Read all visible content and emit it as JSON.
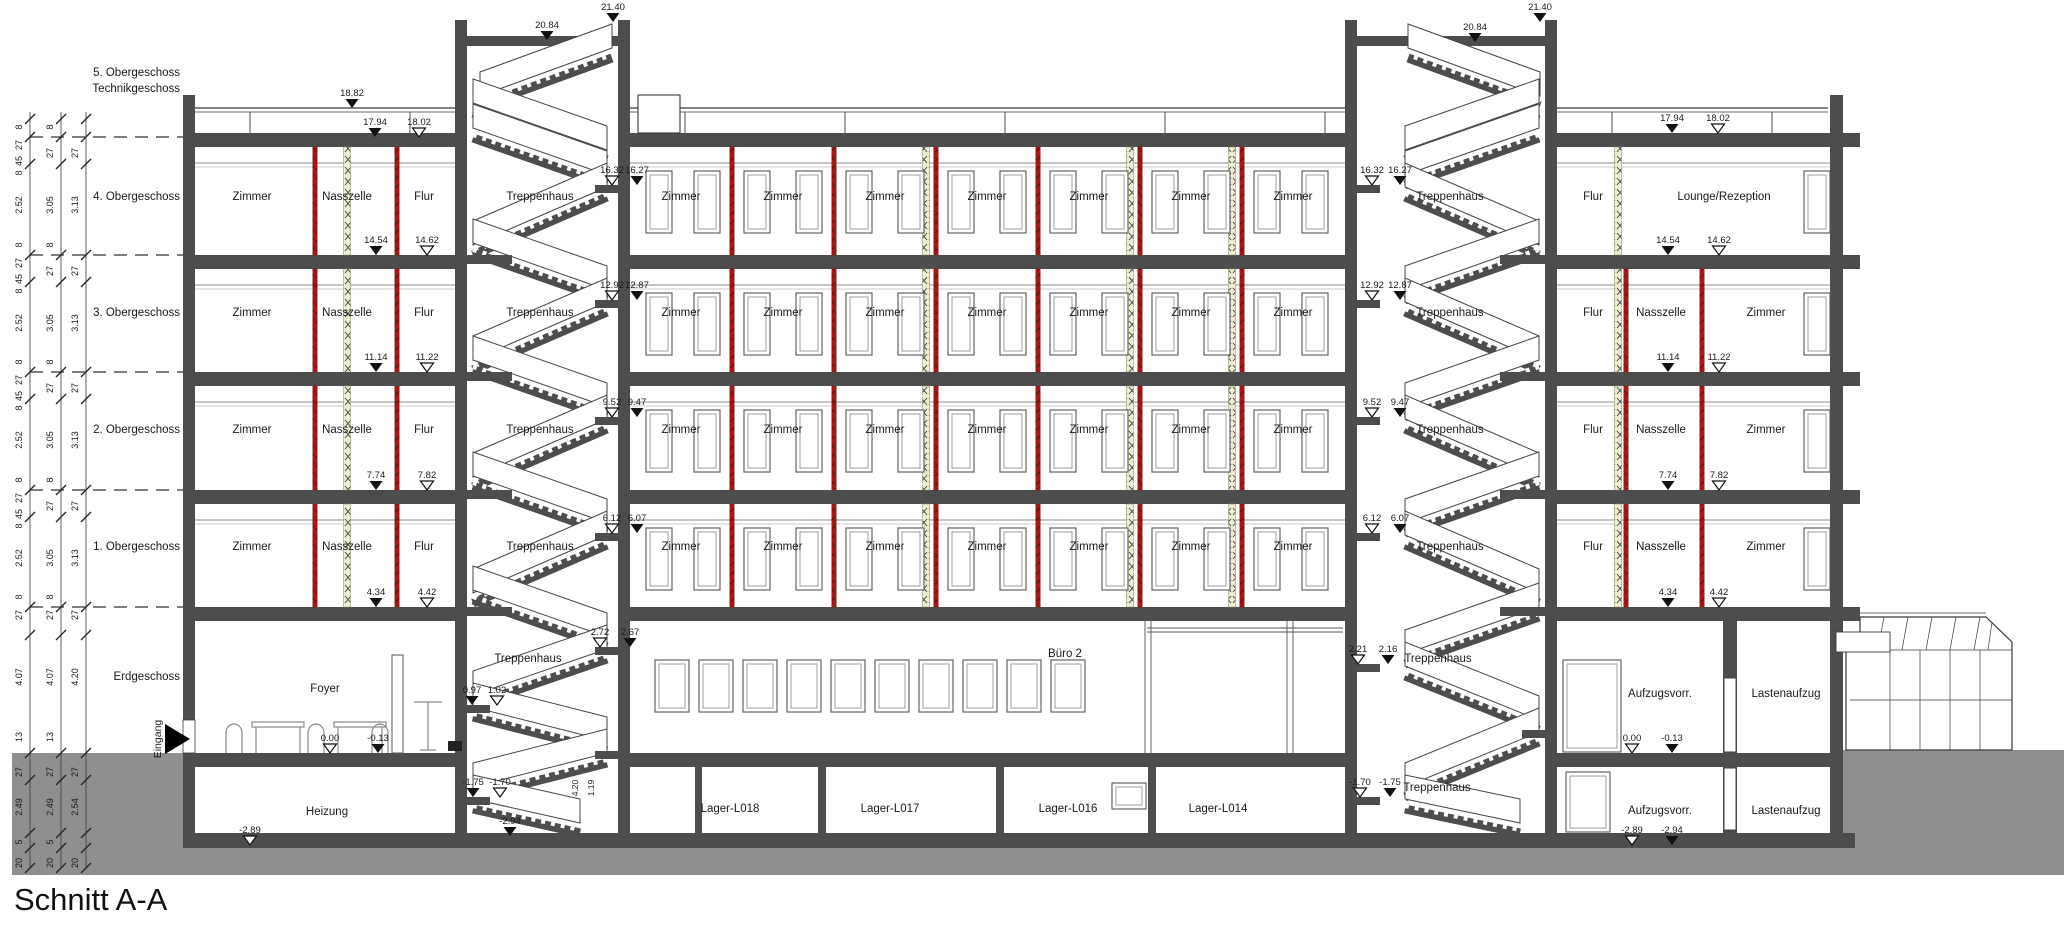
{
  "title": "Schnitt A-A",
  "storey_labels": [
    {
      "text": "5. Obergeschoss",
      "x": 180,
      "y": 76
    },
    {
      "text": "Technikgeschoss",
      "x": 180,
      "y": 92
    },
    {
      "text": "4. Obergeschoss",
      "x": 180,
      "y": 200
    },
    {
      "text": "3. Obergeschoss",
      "x": 180,
      "y": 316
    },
    {
      "text": "2. Obergeschoss",
      "x": 180,
      "y": 433
    },
    {
      "text": "1. Obergeschoss",
      "x": 180,
      "y": 550
    },
    {
      "text": "Erdgeschoss",
      "x": 180,
      "y": 680
    }
  ],
  "entrance_label": {
    "text": "Eingang",
    "x": 161,
    "y": 739
  },
  "room_labels": [
    {
      "t": "Zimmer",
      "x": 252,
      "y": 200
    },
    {
      "t": "Nasszelle",
      "x": 347,
      "y": 200
    },
    {
      "t": "Flur",
      "x": 424,
      "y": 200
    },
    {
      "t": "Treppenhaus",
      "x": 540,
      "y": 200
    },
    {
      "t": "Zimmer",
      "x": 681,
      "y": 200
    },
    {
      "t": "Zimmer",
      "x": 783,
      "y": 200
    },
    {
      "t": "Zimmer",
      "x": 885,
      "y": 200
    },
    {
      "t": "Zimmer",
      "x": 987,
      "y": 200
    },
    {
      "t": "Zimmer",
      "x": 1089,
      "y": 200
    },
    {
      "t": "Zimmer",
      "x": 1191,
      "y": 200
    },
    {
      "t": "Zimmer",
      "x": 1293,
      "y": 200
    },
    {
      "t": "Treppenhaus",
      "x": 1450,
      "y": 200
    },
    {
      "t": "Flur",
      "x": 1593,
      "y": 200
    },
    {
      "t": "Lounge/Rezeption",
      "x": 1724,
      "y": 200
    },
    {
      "t": "Zimmer",
      "x": 252,
      "y": 316
    },
    {
      "t": "Nasszelle",
      "x": 347,
      "y": 316
    },
    {
      "t": "Flur",
      "x": 424,
      "y": 316
    },
    {
      "t": "Treppenhaus",
      "x": 540,
      "y": 316
    },
    {
      "t": "Zimmer",
      "x": 681,
      "y": 316
    },
    {
      "t": "Zimmer",
      "x": 783,
      "y": 316
    },
    {
      "t": "Zimmer",
      "x": 885,
      "y": 316
    },
    {
      "t": "Zimmer",
      "x": 987,
      "y": 316
    },
    {
      "t": "Zimmer",
      "x": 1089,
      "y": 316
    },
    {
      "t": "Zimmer",
      "x": 1191,
      "y": 316
    },
    {
      "t": "Zimmer",
      "x": 1293,
      "y": 316
    },
    {
      "t": "Treppenhaus",
      "x": 1450,
      "y": 316
    },
    {
      "t": "Flur",
      "x": 1593,
      "y": 316
    },
    {
      "t": "Nasszelle",
      "x": 1661,
      "y": 316
    },
    {
      "t": "Zimmer",
      "x": 1766,
      "y": 316
    },
    {
      "t": "Zimmer",
      "x": 252,
      "y": 433
    },
    {
      "t": "Nasszelle",
      "x": 347,
      "y": 433
    },
    {
      "t": "Flur",
      "x": 424,
      "y": 433
    },
    {
      "t": "Treppenhaus",
      "x": 540,
      "y": 433
    },
    {
      "t": "Zimmer",
      "x": 681,
      "y": 433
    },
    {
      "t": "Zimmer",
      "x": 783,
      "y": 433
    },
    {
      "t": "Zimmer",
      "x": 885,
      "y": 433
    },
    {
      "t": "Zimmer",
      "x": 987,
      "y": 433
    },
    {
      "t": "Zimmer",
      "x": 1089,
      "y": 433
    },
    {
      "t": "Zimmer",
      "x": 1191,
      "y": 433
    },
    {
      "t": "Zimmer",
      "x": 1293,
      "y": 433
    },
    {
      "t": "Treppenhaus",
      "x": 1450,
      "y": 433
    },
    {
      "t": "Flur",
      "x": 1593,
      "y": 433
    },
    {
      "t": "Nasszelle",
      "x": 1661,
      "y": 433
    },
    {
      "t": "Zimmer",
      "x": 1766,
      "y": 433
    },
    {
      "t": "Zimmer",
      "x": 252,
      "y": 550
    },
    {
      "t": "Nasszelle",
      "x": 347,
      "y": 550
    },
    {
      "t": "Flur",
      "x": 424,
      "y": 550
    },
    {
      "t": "Treppenhaus",
      "x": 540,
      "y": 550
    },
    {
      "t": "Zimmer",
      "x": 681,
      "y": 550
    },
    {
      "t": "Zimmer",
      "x": 783,
      "y": 550
    },
    {
      "t": "Zimmer",
      "x": 885,
      "y": 550
    },
    {
      "t": "Zimmer",
      "x": 987,
      "y": 550
    },
    {
      "t": "Zimmer",
      "x": 1089,
      "y": 550
    },
    {
      "t": "Zimmer",
      "x": 1191,
      "y": 550
    },
    {
      "t": "Zimmer",
      "x": 1293,
      "y": 550
    },
    {
      "t": "Treppenhaus",
      "x": 1450,
      "y": 550
    },
    {
      "t": "Flur",
      "x": 1593,
      "y": 550
    },
    {
      "t": "Nasszelle",
      "x": 1661,
      "y": 550
    },
    {
      "t": "Zimmer",
      "x": 1766,
      "y": 550
    },
    {
      "t": "Foyer",
      "x": 325,
      "y": 692
    },
    {
      "t": "Treppenhaus",
      "x": 528,
      "y": 662
    },
    {
      "t": "Büro 2",
      "x": 1065,
      "y": 657
    },
    {
      "t": "Treppenhaus",
      "x": 1438,
      "y": 662
    },
    {
      "t": "Aufzugsvorr.",
      "x": 1660,
      "y": 697
    },
    {
      "t": "Lastenaufzug",
      "x": 1786,
      "y": 697
    },
    {
      "t": "Heizung",
      "x": 327,
      "y": 815
    },
    {
      "t": "Lager-L018",
      "x": 730,
      "y": 812
    },
    {
      "t": "Lager-L017",
      "x": 890,
      "y": 812
    },
    {
      "t": "Lager-L016",
      "x": 1068,
      "y": 812
    },
    {
      "t": "Lager-L014",
      "x": 1218,
      "y": 812
    },
    {
      "t": "Treppenhaus",
      "x": 1437,
      "y": 791
    },
    {
      "t": "Aufzugsvorr.",
      "x": 1660,
      "y": 814
    },
    {
      "t": "Lastenaufzug",
      "x": 1786,
      "y": 814
    }
  ],
  "elevation_markers": [
    {
      "t": "21.40",
      "x": 613,
      "y": 22,
      "s": "f"
    },
    {
      "t": "20.84",
      "x": 547,
      "y": 40,
      "s": "f"
    },
    {
      "t": "21.40",
      "x": 1540,
      "y": 22,
      "s": "f"
    },
    {
      "t": "20.84",
      "x": 1475,
      "y": 42,
      "s": "f"
    },
    {
      "t": "18.82",
      "x": 352,
      "y": 108,
      "s": "f"
    },
    {
      "t": "17.94",
      "x": 375,
      "y": 137,
      "s": "f"
    },
    {
      "t": "18.02",
      "x": 419,
      "y": 137,
      "s": "o"
    },
    {
      "t": "17.94",
      "x": 1672,
      "y": 133,
      "s": "f"
    },
    {
      "t": "18.02",
      "x": 1718,
      "y": 133,
      "s": "o"
    },
    {
      "t": "14.54",
      "x": 376,
      "y": 255,
      "s": "f"
    },
    {
      "t": "14.62",
      "x": 427,
      "y": 255,
      "s": "o"
    },
    {
      "t": "11.14",
      "x": 376,
      "y": 372,
      "s": "f"
    },
    {
      "t": "11.22",
      "x": 427,
      "y": 372,
      "s": "o"
    },
    {
      "t": "7.74",
      "x": 376,
      "y": 490,
      "s": "f"
    },
    {
      "t": "7.82",
      "x": 427,
      "y": 490,
      "s": "o"
    },
    {
      "t": "4.34",
      "x": 376,
      "y": 607,
      "s": "f"
    },
    {
      "t": "4.42",
      "x": 427,
      "y": 607,
      "s": "o"
    },
    {
      "t": "14.54",
      "x": 1668,
      "y": 255,
      "s": "f"
    },
    {
      "t": "14.62",
      "x": 1719,
      "y": 255,
      "s": "o"
    },
    {
      "t": "11.14",
      "x": 1668,
      "y": 372,
      "s": "f"
    },
    {
      "t": "11.22",
      "x": 1719,
      "y": 372,
      "s": "o"
    },
    {
      "t": "7.74",
      "x": 1668,
      "y": 490,
      "s": "f"
    },
    {
      "t": "7.82",
      "x": 1719,
      "y": 490,
      "s": "o"
    },
    {
      "t": "4.34",
      "x": 1668,
      "y": 607,
      "s": "f"
    },
    {
      "t": "4.42",
      "x": 1719,
      "y": 607,
      "s": "o"
    },
    {
      "t": "0.00",
      "x": 330,
      "y": 753,
      "s": "o"
    },
    {
      "t": "-0.13",
      "x": 378,
      "y": 753,
      "s": "f"
    },
    {
      "t": "0.00",
      "x": 1632,
      "y": 753,
      "s": "o"
    },
    {
      "t": "-0.13",
      "x": 1672,
      "y": 753,
      "s": "f"
    },
    {
      "t": "-2.89",
      "x": 250,
      "y": 845,
      "s": "o"
    },
    {
      "t": "-2.89",
      "x": 1632,
      "y": 845,
      "s": "o"
    },
    {
      "t": "-2.94",
      "x": 1672,
      "y": 845,
      "s": "f"
    },
    {
      "t": "16.32",
      "x": 612,
      "y": 185,
      "s": "o"
    },
    {
      "t": "16.27",
      "x": 637,
      "y": 185,
      "s": "f"
    },
    {
      "t": "12.92",
      "x": 612,
      "y": 300,
      "s": "o"
    },
    {
      "t": "12.87",
      "x": 637,
      "y": 300,
      "s": "f"
    },
    {
      "t": "9.52",
      "x": 612,
      "y": 417,
      "s": "o"
    },
    {
      "t": "9.47",
      "x": 637,
      "y": 417,
      "s": "f"
    },
    {
      "t": "6.12",
      "x": 612,
      "y": 533,
      "s": "o"
    },
    {
      "t": "6.07",
      "x": 637,
      "y": 533,
      "s": "f"
    },
    {
      "t": "2.72",
      "x": 600,
      "y": 647,
      "s": "o"
    },
    {
      "t": "2.67",
      "x": 630,
      "y": 647,
      "s": "f"
    },
    {
      "t": "0.97",
      "x": 472,
      "y": 705,
      "s": "f"
    },
    {
      "t": "1.02",
      "x": 497,
      "y": 705,
      "s": "o"
    },
    {
      "t": "-1.75",
      "x": 473,
      "y": 797,
      "s": "f"
    },
    {
      "t": "-1.70",
      "x": 500,
      "y": 797,
      "s": "o"
    },
    {
      "t": "-2.94",
      "x": 510,
      "y": 836,
      "s": "f"
    },
    {
      "t": "16.32",
      "x": 1372,
      "y": 185,
      "s": "o"
    },
    {
      "t": "16.27",
      "x": 1400,
      "y": 185,
      "s": "f"
    },
    {
      "t": "12.92",
      "x": 1372,
      "y": 300,
      "s": "o"
    },
    {
      "t": "12.87",
      "x": 1400,
      "y": 300,
      "s": "f"
    },
    {
      "t": "9.52",
      "x": 1372,
      "y": 417,
      "s": "o"
    },
    {
      "t": "9.47",
      "x": 1400,
      "y": 417,
      "s": "f"
    },
    {
      "t": "6.12",
      "x": 1372,
      "y": 533,
      "s": "o"
    },
    {
      "t": "6.07",
      "x": 1400,
      "y": 533,
      "s": "f"
    },
    {
      "t": "2.21",
      "x": 1358,
      "y": 664,
      "s": "o"
    },
    {
      "t": "2.16",
      "x": 1388,
      "y": 664,
      "s": "f"
    },
    {
      "t": "-1.70",
      "x": 1360,
      "y": 797,
      "s": "o"
    },
    {
      "t": "-1.75",
      "x": 1390,
      "y": 797,
      "s": "f"
    }
  ],
  "dimension_columns": [
    {
      "x": 30,
      "e": [
        [
          127,
          "8"
        ],
        [
          145,
          "27"
        ],
        [
          161,
          "45"
        ],
        [
          173,
          "8"
        ],
        [
          205,
          "2.52"
        ],
        [
          245,
          "8"
        ],
        [
          263,
          "27"
        ],
        [
          279,
          "45"
        ],
        [
          291,
          "8"
        ],
        [
          323,
          "2.52"
        ],
        [
          362,
          "8"
        ],
        [
          380,
          "27"
        ],
        [
          396,
          "45"
        ],
        [
          408,
          "8"
        ],
        [
          440,
          "2.52"
        ],
        [
          480,
          "8"
        ],
        [
          498,
          "27"
        ],
        [
          514,
          "45"
        ],
        [
          526,
          "8"
        ],
        [
          558,
          "2.52"
        ],
        [
          597,
          "8"
        ],
        [
          615,
          "27"
        ],
        [
          677,
          "4.07"
        ],
        [
          737,
          "13"
        ],
        [
          772,
          "27"
        ],
        [
          807,
          "2.49"
        ],
        [
          842,
          "5"
        ],
        [
          863,
          "20"
        ]
      ]
    },
    {
      "x": 61,
      "e": [
        [
          127,
          "8"
        ],
        [
          153,
          "27"
        ],
        [
          205,
          "3.05"
        ],
        [
          245,
          "8"
        ],
        [
          271,
          "27"
        ],
        [
          323,
          "3.05"
        ],
        [
          362,
          "8"
        ],
        [
          388,
          "27"
        ],
        [
          440,
          "3.05"
        ],
        [
          480,
          "8"
        ],
        [
          506,
          "27"
        ],
        [
          558,
          "3.05"
        ],
        [
          597,
          "8"
        ],
        [
          615,
          "27"
        ],
        [
          677,
          "4.07"
        ],
        [
          737,
          "13"
        ],
        [
          772,
          "27"
        ],
        [
          807,
          "2.49"
        ],
        [
          842,
          "5"
        ],
        [
          863,
          "20"
        ]
      ]
    },
    {
      "x": 86,
      "e": [
        [
          153,
          "27"
        ],
        [
          205,
          "3.13"
        ],
        [
          271,
          "27"
        ],
        [
          323,
          "3.13"
        ],
        [
          388,
          "27"
        ],
        [
          440,
          "3.13"
        ],
        [
          506,
          "27"
        ],
        [
          558,
          "3.13"
        ],
        [
          615,
          "27"
        ],
        [
          677,
          "4.20"
        ],
        [
          772,
          "27"
        ],
        [
          807,
          "2.54"
        ],
        [
          863,
          "20"
        ]
      ]
    }
  ],
  "extra_dims": [
    {
      "x": 578,
      "y": 788,
      "t": "4.20"
    },
    {
      "x": 594,
      "y": 788,
      "t": "1.19"
    }
  ],
  "drawing_colors": {
    "wall": "#4d4d4d",
    "ground": "#8f8f8f",
    "divider_red": "#a81616",
    "divider_red_dark": "#6d0d0d",
    "shaft_hatch": "#ededd0",
    "thin_line": "#3a3a3a"
  }
}
